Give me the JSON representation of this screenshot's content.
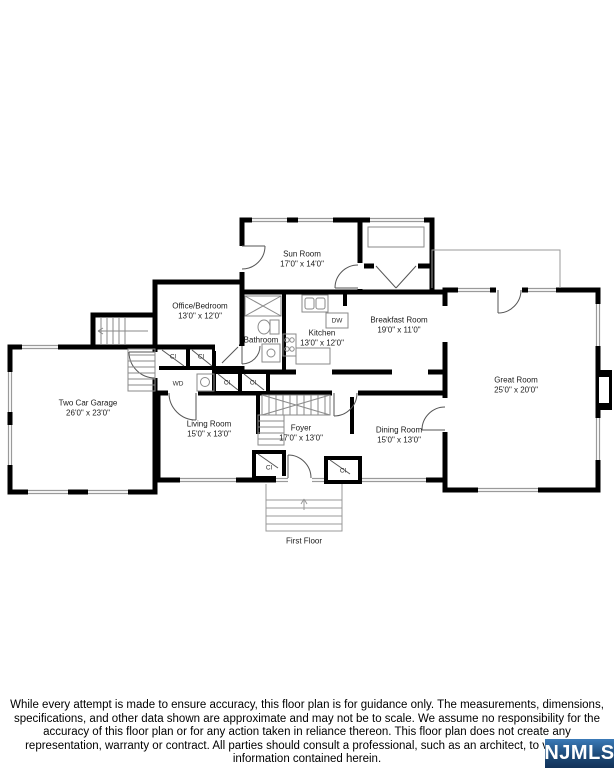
{
  "floor_plan": {
    "rooms": [
      {
        "id": "sun-room",
        "name": "Sun Room",
        "dims": "17'0\" x 14'0\""
      },
      {
        "id": "office-bedroom",
        "name": "Office/Bedroom",
        "dims": "13'0\" x 12'0\""
      },
      {
        "id": "bathroom",
        "name": "Bathroom",
        "dims": ""
      },
      {
        "id": "kitchen",
        "name": "Kitchen",
        "dims": "13'0\" x 12'0\""
      },
      {
        "id": "breakfast-room",
        "name": "Breakfast Room",
        "dims": "19'0\" x 11'0\""
      },
      {
        "id": "great-room",
        "name": "Great Room",
        "dims": "25'0\" x 20'0\""
      },
      {
        "id": "two-car-garage",
        "name": "Two Car Garage",
        "dims": "26'0\" x 23'0\""
      },
      {
        "id": "living-room",
        "name": "Living Room",
        "dims": "15'0\" x 13'0\""
      },
      {
        "id": "foyer",
        "name": "Foyer",
        "dims": "17'0\" x 13'0\""
      },
      {
        "id": "dining-room",
        "name": "Dining Room",
        "dims": "15'0\" x 13'0\""
      }
    ],
    "fixture_labels": {
      "dishwasher": "DW",
      "washer_dryer": "WD",
      "closet": "Cl"
    },
    "floor_label": "First Floor",
    "line_color": "#000000"
  },
  "footer": {
    "disclaimer": "While every attempt is made to ensure accuracy, this floor plan is for guidance only. The measurements, dimensions, specifications, and other data shown are approximate and may not be to scale. We assume no responsibility for the accuracy of this floor plan or for any action taken in reliance thereon. This floor plan does not create any representation, warranty or contract. All parties should consult a professional, such as an architect, to verify the information contained herein.",
    "logo_text": "NJMLS",
    "logo_colors": {
      "top": "#3b7ab8",
      "bottom": "#123258",
      "text": "#ffffff"
    }
  }
}
